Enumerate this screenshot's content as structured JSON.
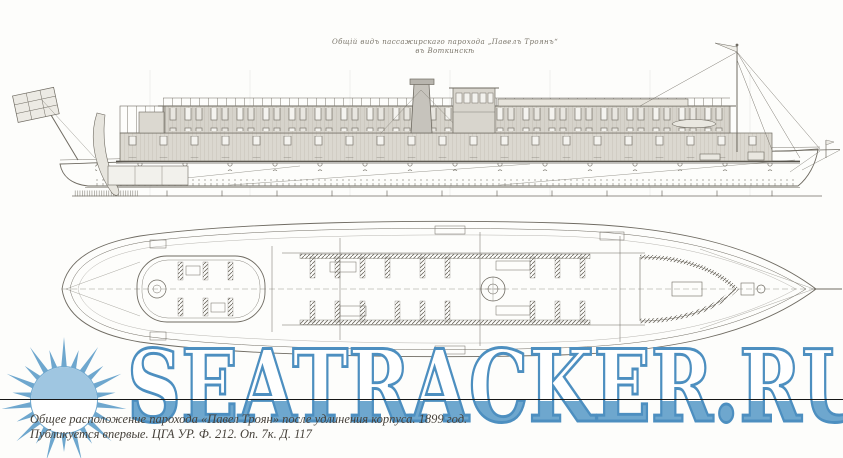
{
  "drawing": {
    "title_line1": "Общій видъ пассажирскаго парохода „Павелъ Троянъ“",
    "title_line2": "въ Воткинскѣ",
    "ink_color": "#6f6b62",
    "cabin_fill": "#dbd8d0",
    "views": [
      "side-elevation",
      "main-deck-plan"
    ]
  },
  "watermark": {
    "text": "SEATRACKER.RU",
    "sun_icon": "sun-rays-logo",
    "blue": "#6ea7ce",
    "outline_blue": "#4d8fc0",
    "light_blue": "#9fc6e1",
    "strike_line_color": "#161616"
  },
  "caption": {
    "line1": "Общее расположение парохода «Павел Троян» после удлинения корпуса. 1899 год.",
    "line2": "Публикуется впервые. ЦГА УР. Ф. 212. Оп. 7к. Д. 117"
  }
}
